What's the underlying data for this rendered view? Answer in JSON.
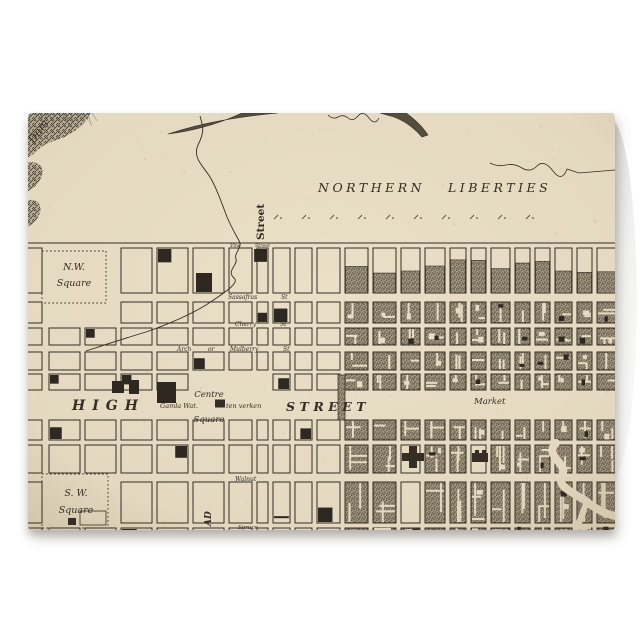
{
  "product": {
    "kind": "Folded greeting card with vintage engraved city map print"
  },
  "colors": {
    "background": "#ffffff",
    "paper": "#eadfc7",
    "ink": "#332d24",
    "stipple": "#a59b85",
    "card_back": "#f2f2f1"
  },
  "map": {
    "labels": [
      {
        "id": "dam",
        "text": "Dam",
        "x": 6,
        "y": 31,
        "size": 11,
        "rot": -55
      },
      {
        "id": "northern",
        "text": "NORTHERN",
        "x": 290,
        "y": 79,
        "size": 12.5,
        "ls": 3.5
      },
      {
        "id": "liberties",
        "text": "LIBERTIES",
        "x": 420,
        "y": 79,
        "size": 12.5,
        "ls": 3.5
      },
      {
        "id": "street-vertical",
        "text": "Street",
        "x": 236,
        "y": 127,
        "size": 10.5,
        "rot": -90,
        "weight": 700,
        "upright": true
      },
      {
        "id": "vine",
        "text": "Vine",
        "x": 202,
        "y": 134,
        "size": 4.8
      },
      {
        "id": "vine-street",
        "text": "Street",
        "x": 227,
        "y": 134,
        "size": 4.8
      },
      {
        "id": "nw-line1",
        "text": "N.W.",
        "x": 46,
        "y": 157,
        "size": 9.5,
        "anchor": "middle"
      },
      {
        "id": "nw-line2",
        "text": "Square",
        "x": 46,
        "y": 173,
        "size": 9.5,
        "anchor": "middle"
      },
      {
        "id": "sassafras",
        "text": "Sassafras",
        "x": 200,
        "y": 186,
        "size": 6
      },
      {
        "id": "sassafras-st",
        "text": "St",
        "x": 253,
        "y": 186,
        "size": 6
      },
      {
        "id": "cherry",
        "text": "Cherry",
        "x": 207,
        "y": 213,
        "size": 6
      },
      {
        "id": "cherry-st",
        "text": "St",
        "x": 252,
        "y": 213,
        "size": 6
      },
      {
        "id": "arch",
        "text": "Arch",
        "x": 149,
        "y": 238,
        "size": 6
      },
      {
        "id": "arch-or",
        "text": "or",
        "x": 180,
        "y": 238,
        "size": 6
      },
      {
        "id": "mulberry",
        "text": "Mulberry",
        "x": 202,
        "y": 238,
        "size": 6
      },
      {
        "id": "mulberry-st",
        "text": "St",
        "x": 255,
        "y": 238,
        "size": 6
      },
      {
        "id": "high",
        "text": "HIGH",
        "x": 44,
        "y": 297,
        "size": 14,
        "ls": 7,
        "weight": 600
      },
      {
        "id": "street-mid",
        "text": "STREET",
        "x": 258,
        "y": 298,
        "size": 12.5,
        "ls": 4.5,
        "weight": 600
      },
      {
        "id": "market",
        "text": "Market",
        "x": 446,
        "y": 291,
        "size": 8.5
      },
      {
        "id": "centre",
        "text": "Centre",
        "x": 181,
        "y": 284,
        "size": 8.5,
        "anchor": "middle"
      },
      {
        "id": "gamla",
        "text": "Gamla Wat.",
        "x": 132,
        "y": 295,
        "size": 6.5
      },
      {
        "id": "verken",
        "text": "ten verken",
        "x": 198,
        "y": 295,
        "size": 6.5
      },
      {
        "id": "centre-square",
        "text": "Square",
        "x": 181,
        "y": 309,
        "size": 8.5,
        "anchor": "middle"
      },
      {
        "id": "sw-line1",
        "text": "S. W.",
        "x": 48,
        "y": 383,
        "size": 9.5,
        "anchor": "middle"
      },
      {
        "id": "sw-line2",
        "text": "Square",
        "x": 48,
        "y": 400,
        "size": 9.5,
        "anchor": "middle"
      },
      {
        "id": "walnut",
        "text": "Walnut",
        "x": 207,
        "y": 368,
        "size": 6
      },
      {
        "id": "broad",
        "text": "AD",
        "x": 183,
        "y": 413,
        "size": 9,
        "rot": -90,
        "weight": 600
      },
      {
        "id": "spruce",
        "text": "Spruce",
        "x": 210,
        "y": 416,
        "size": 5.5
      }
    ]
  }
}
